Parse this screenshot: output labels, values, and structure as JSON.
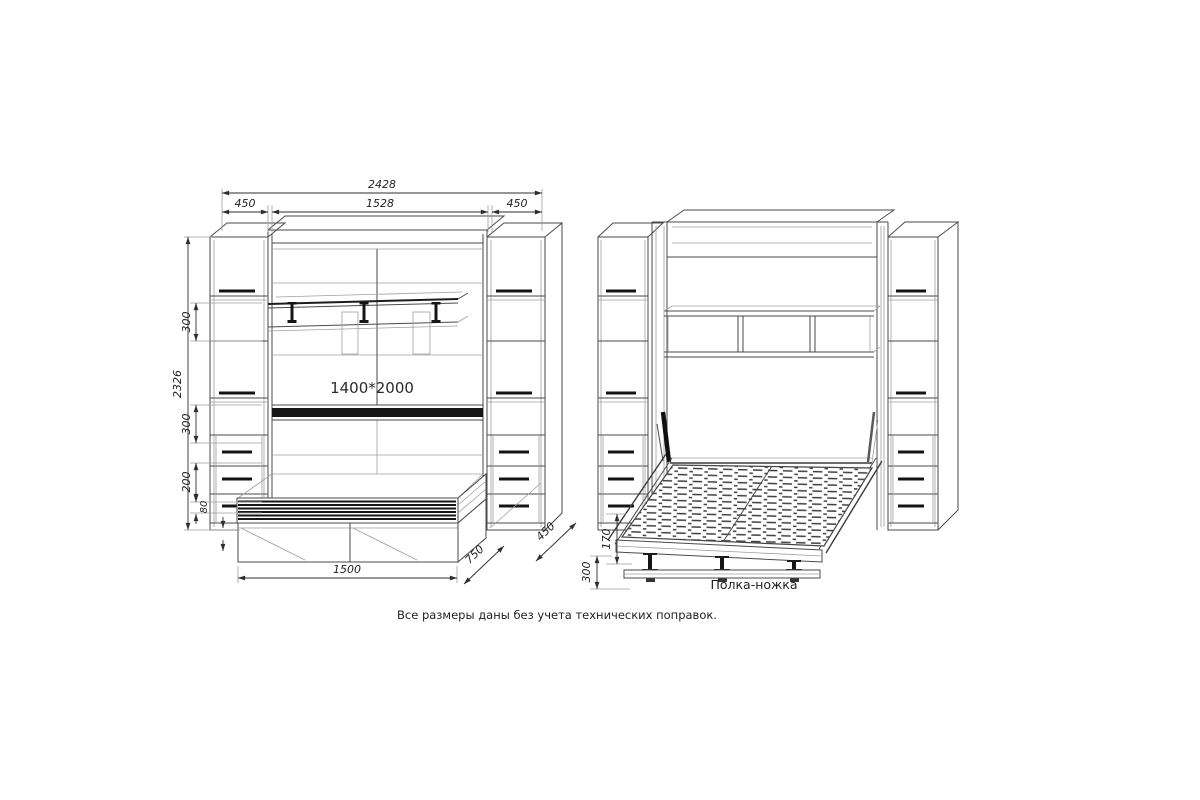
{
  "drawing": {
    "closed_view": {
      "width_total_mm": "2428",
      "width_left_cabinet_mm": "450",
      "width_center_mm": "1528",
      "width_right_cabinet_mm": "450",
      "height_total_mm": "2326",
      "height_upper_shelf_mm": "300",
      "height_lower_shelf_mm": "300",
      "height_drawer_zone_mm": "200",
      "height_plinth_mm": "80",
      "bench_length_mm": "1500",
      "bench_depth_mm": "750",
      "cabinet_depth_mm": "450",
      "sleeping_area_label": "1400*2000"
    },
    "open_view": {
      "platform_height_mm": "170",
      "floor_clearance_mm": "300",
      "leg_shelf_label": "Полка-ножка"
    },
    "footnote": "Все размеры даны без учета технических поправок.",
    "colors": {
      "background": "#ffffff",
      "line": "#4a4a4a",
      "dark_accent": "#141414",
      "dimension": "#2e2e2e"
    }
  }
}
